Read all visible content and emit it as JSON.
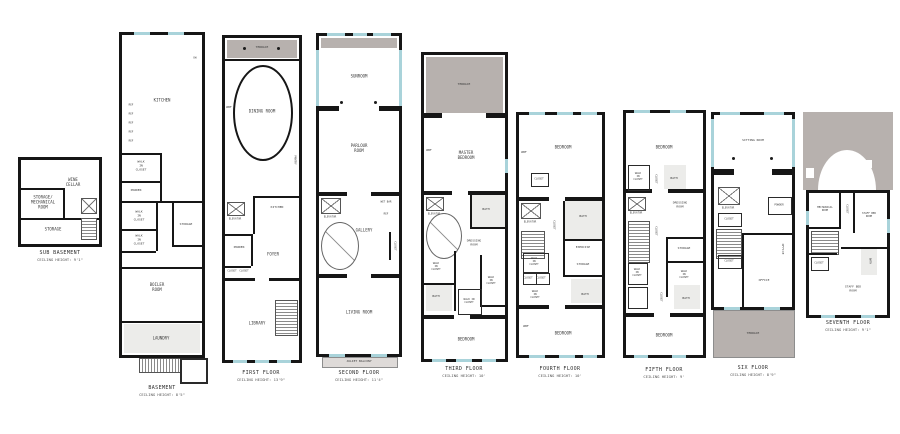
{
  "palette": {
    "wall": "#161616",
    "terrace": "#b7b1ae",
    "window": "#a9d3da",
    "tile": "#ececea",
    "text": "#3b3b3b"
  },
  "floors": [
    {
      "name": "SUB BASEMENT",
      "ceiling": "CEILING HEIGHT: 9'1\"",
      "rooms": [
        "WINE\nCELLAR",
        "STORAGE/\nMECHANICAL\nROOM",
        "STORAGE"
      ]
    },
    {
      "name": "BASEMENT",
      "ceiling": "CEILING HEIGHT: 8'5\"",
      "rooms": [
        "KITCHEN",
        "REF",
        "REF",
        "REF",
        "REF",
        "REF",
        "DW",
        "WALK\nIN\nCLOSET",
        "POWDER",
        "WALK\nIN\nCLOSET",
        "WALK\nIN\nCLOSET",
        "STORAGE",
        "BOILER\nROOM",
        "LAUNDRY"
      ]
    },
    {
      "name": "FIRST FLOOR",
      "ceiling": "CEILING HEIGHT: 13'9\"",
      "rooms": [
        "TERRACE",
        "DINING ROOM",
        "WBF",
        "PANTRY",
        "KITCHEN",
        "ELEVATOR",
        "POWDER",
        "CLOSET",
        "CLOSET",
        "FOYER",
        "LIBRARY"
      ]
    },
    {
      "name": "SECOND FLOOR",
      "ceiling": "CEILING HEIGHT: 11'4\"",
      "rooms": [
        "SUNROOM",
        "PARLOUR\nROOM",
        "ELEVATOR",
        "WET BAR",
        "REF",
        "GALLERY",
        "CLOSET",
        "LIVING ROOM",
        "JULIET BALCONY"
      ]
    },
    {
      "name": "THIRD FLOOR",
      "ceiling": "CEILING HEIGHT: 10'",
      "rooms": [
        "TERRACE",
        "MASTER\nBEDROOM",
        "WBF",
        "ELEVATOR",
        "BATH",
        "DRESSING\nROOM",
        "WALK\nIN\nCLOSET",
        "WALK\nIN\nCLOSET",
        "BATH",
        "WALK IN\nCLOSET",
        "BEDROOM"
      ]
    },
    {
      "name": "FOURTH FLOOR",
      "ceiling": "CEILING HEIGHT: 10'",
      "rooms": [
        "BEDROOM",
        "WBF",
        "CLOSET",
        "ELEVATOR",
        "BATH",
        "CLOSET",
        "EXERCISE",
        "WALK\nIN\nCLOSET",
        "CLOSET",
        "CLOSET",
        "STORAGE",
        "WALK\nIN\nCLOSET",
        "BATH",
        "WBF",
        "BEDROOM"
      ]
    },
    {
      "name": "FIFTH FLOOR",
      "ceiling": "CEILING HEIGHT: 9'",
      "rooms": [
        "BEDROOM",
        "WALK\nIN\nCLOSET",
        "CLOSET",
        "BATH",
        "ELEVATOR",
        "DRESSING\nROOM",
        "CLOSET",
        "STORAGE",
        "WALK\nIN\nCLOSET",
        "WALK\nIN\nCLOSET",
        "CLOSET",
        "BATH",
        "BEDROOM"
      ]
    },
    {
      "name": "SIX FLOOR",
      "ceiling": "CEILING HEIGHT: 8'9\"",
      "rooms": [
        "SITTING ROOM",
        "ELEVATOR",
        "CLOSET",
        "POWDER",
        "OFFICE",
        "CLOSET",
        "OFFICE",
        "TERRACE"
      ]
    },
    {
      "name": "SEVENTH FLOOR",
      "ceiling": "CEILING HEIGHT: 9'1\"",
      "rooms": [
        "MECHANICAL\nROOM",
        "CLOSET",
        "STAFF BED\nROOM",
        "BATH",
        "CLOSET",
        "STAFF BED\nROOM"
      ]
    }
  ]
}
